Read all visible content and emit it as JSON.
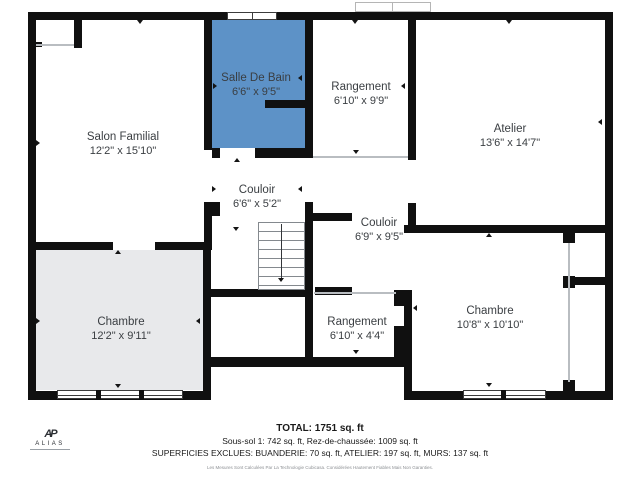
{
  "floorplan": {
    "rooms": {
      "salon": {
        "name": "Salon Familial",
        "dims": "12'2\" x 15'10\""
      },
      "salle_de_bain": {
        "name": "Salle De Bain",
        "dims": "6'6\" x 9'5\""
      },
      "rangement_haut": {
        "name": "Rangement",
        "dims": "6'10\" x 9'9\""
      },
      "atelier": {
        "name": "Atelier",
        "dims": "13'6\" x 14'7\""
      },
      "couloir_haut": {
        "name": "Couloir",
        "dims": "6'6\" x 5'2\""
      },
      "couloir_droit": {
        "name": "Couloir",
        "dims": "6'9\" x 9'5\""
      },
      "chambre_gauche": {
        "name": "Chambre",
        "dims": "12'2\" x 9'11\""
      },
      "rangement_bas": {
        "name": "Rangement",
        "dims": "6'10\" x 4'4\""
      },
      "chambre_droite": {
        "name": "Chambre",
        "dims": "10'8\" x 10'10\""
      }
    },
    "colors": {
      "bathroom_blue": "#5d92c7",
      "bedroom_gray": "#e8e9eb",
      "wall_black": "#101010"
    }
  },
  "summary": {
    "total": "TOTAL: 1751 sq. ft",
    "levels": "Sous-sol 1: 742 sq. ft, Rez-de-chaussée: 1009 sq. ft",
    "exclusions": "SUPERFICIES EXCLUES: BUANDERIE: 70 sq. ft, ATELIER: 197 sq. ft, MURS: 137 sq. ft",
    "disclaimer": "Les Mesures Sont Calculées Par La Technologie Cubicasa. Considérées Hautement Fiables Mais Non Garanties."
  },
  "logo": {
    "monogram": "AP",
    "brand": "ALIAS"
  }
}
